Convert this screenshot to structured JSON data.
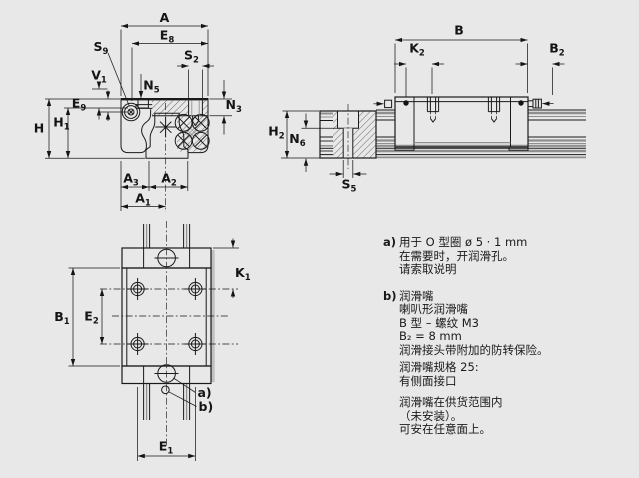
{
  "colors": {
    "background": "#e8e8e8",
    "line": "#1a1a1a",
    "gray_line": "#8f8f8f",
    "shadow": "#c0c0c0"
  },
  "views": {
    "front_section": {
      "dims": {
        "A": {
          "b": "A",
          "s": ""
        },
        "E8": {
          "b": "E",
          "s": "8"
        },
        "S9": {
          "b": "S",
          "s": "9"
        },
        "S2": {
          "b": "S",
          "s": "2"
        },
        "V1": {
          "b": "V",
          "s": "1"
        },
        "N5": {
          "b": "N",
          "s": "5"
        },
        "N3": {
          "b": "N",
          "s": "3"
        },
        "E9": {
          "b": "E",
          "s": "9"
        },
        "H": {
          "b": "H",
          "s": ""
        },
        "H1": {
          "b": "H",
          "s": "1"
        },
        "A3": {
          "b": "A",
          "s": "3"
        },
        "A2": {
          "b": "A",
          "s": "2"
        },
        "A1": {
          "b": "A",
          "s": "1"
        }
      }
    },
    "side": {
      "dims": {
        "B": {
          "b": "B",
          "s": ""
        },
        "K2": {
          "b": "K",
          "s": "2"
        },
        "B2": {
          "b": "B",
          "s": "2"
        },
        "H2": {
          "b": "H",
          "s": "2"
        },
        "N6": {
          "b": "N",
          "s": "6"
        },
        "S5": {
          "b": "S",
          "s": "5"
        }
      }
    },
    "top": {
      "dims": {
        "B1": {
          "b": "B",
          "s": "1"
        },
        "E2": {
          "b": "E",
          "s": "2"
        },
        "K1": {
          "b": "K",
          "s": "1"
        },
        "E1": {
          "b": "E",
          "s": "1"
        }
      },
      "callouts": {
        "a": "a)",
        "b": "b)"
      }
    }
  },
  "notes": {
    "a": {
      "marker": "a)",
      "lines": [
        "用于 O 型圈 ø 5 · 1 mm",
        "在需要时，开润滑孔。",
        "请索取说明"
      ]
    },
    "b": {
      "marker": "b)",
      "lines": [
        "润滑嘴",
        "喇叭形润滑嘴",
        "B 型 – 螺纹 M3",
        "B₂ = 8 mm",
        "润滑接头带附加的防转保险。"
      ]
    },
    "b_spec": {
      "lines": [
        "润滑嘴规格 25:",
        "有侧面接口"
      ]
    },
    "b_scope": {
      "lines": [
        "润滑嘴在供货范围内",
        "（未安装）。",
        "可安在任意面上。"
      ]
    }
  }
}
